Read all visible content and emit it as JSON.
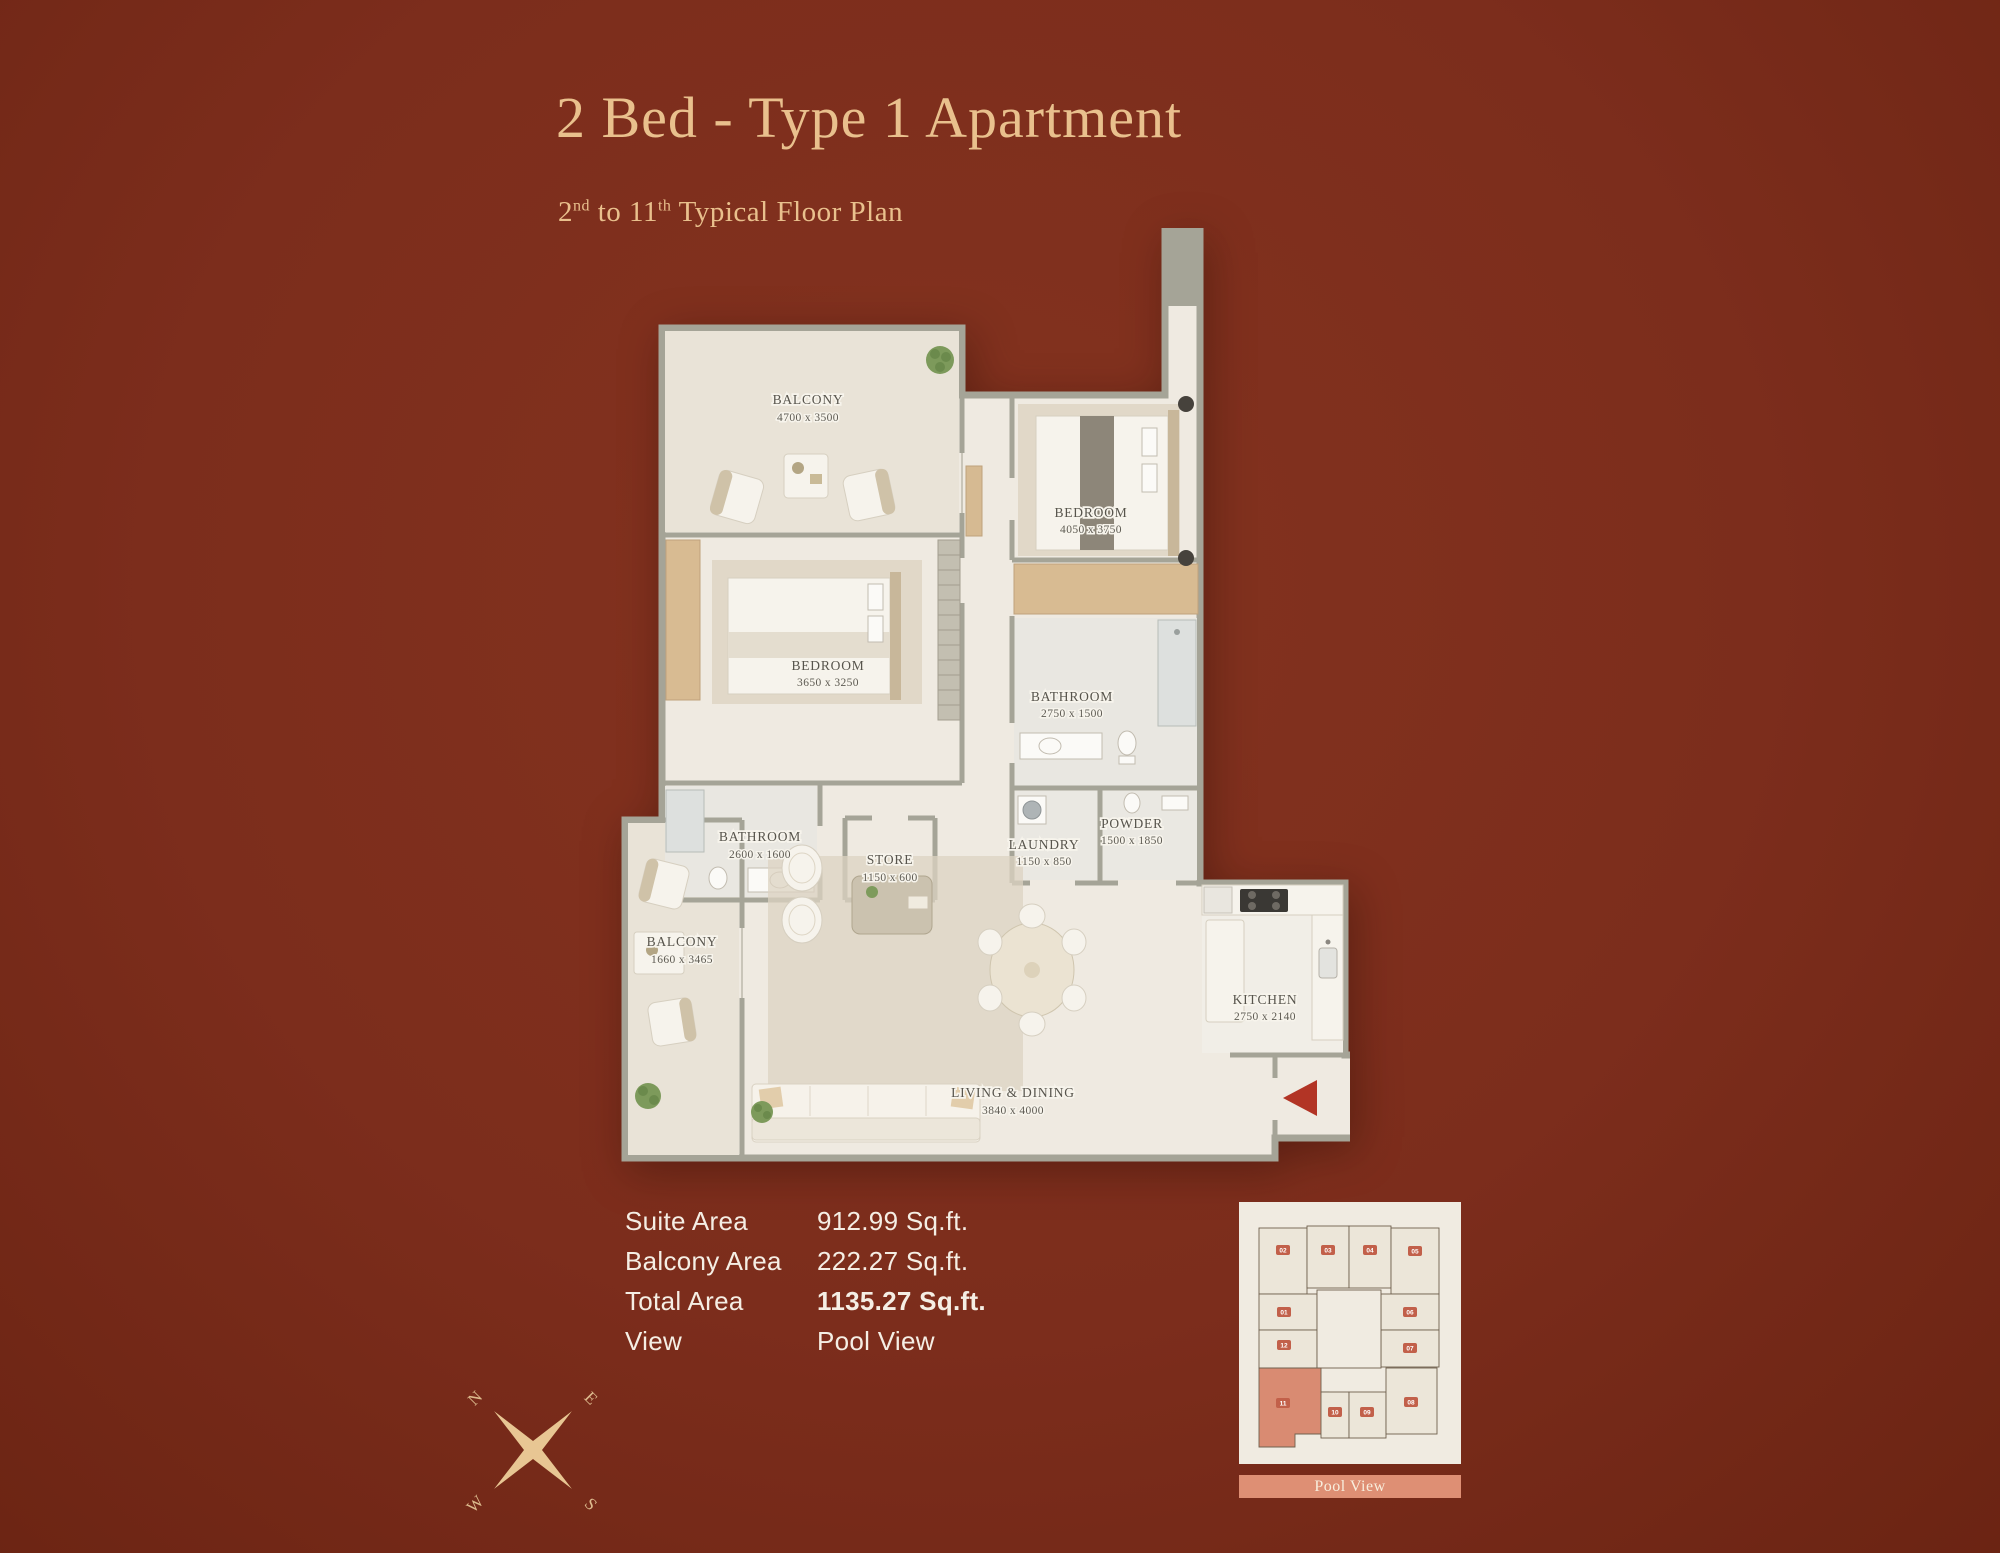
{
  "header": {
    "title": "2 Bed - Type 1 Apartment",
    "subtitle": {
      "base1": "2",
      "sup1": "nd",
      "base2": " to 11",
      "sup2": "th",
      "base3": " Typical Floor Plan"
    }
  },
  "floorplan": {
    "rooms": [
      {
        "name": "BALCONY",
        "dims": "4700 x 3500"
      },
      {
        "name": "BEDROOM",
        "dims": "4050 x 3750"
      },
      {
        "name": "BEDROOM",
        "dims": "3650 x 3250"
      },
      {
        "name": "BATHROOM",
        "dims": "2750 x 1500"
      },
      {
        "name": "POWDER",
        "dims": "1500 x 1850"
      },
      {
        "name": "LAUNDRY",
        "dims": "1150 x 850"
      },
      {
        "name": "BATHROOM",
        "dims": "2600 x 1600"
      },
      {
        "name": "STORE",
        "dims": "1150 x 600"
      },
      {
        "name": "BALCONY",
        "dims": "1660 x 3465"
      },
      {
        "name": "LIVING & DINING",
        "dims": "3840 x 4000"
      },
      {
        "name": "KITCHEN",
        "dims": "2750 x 2140"
      }
    ]
  },
  "areas": {
    "rows": [
      {
        "label": "Suite Area",
        "value": "912.99 Sq.ft."
      },
      {
        "label": "Balcony Area",
        "value": "222.27 Sq.ft."
      },
      {
        "label": "Total Area",
        "value": "1135.27 Sq.ft."
      },
      {
        "label": "View",
        "value": "Pool View"
      }
    ]
  },
  "compass": {
    "n": "N",
    "e": "E",
    "s": "S",
    "w": "W"
  },
  "keyplan": {
    "units": [
      {
        "number": "02"
      },
      {
        "number": "03"
      },
      {
        "number": "04"
      },
      {
        "number": "05"
      },
      {
        "number": "01"
      },
      {
        "number": "12"
      },
      {
        "number": "06"
      },
      {
        "number": "07"
      },
      {
        "number": "11"
      },
      {
        "number": "10"
      },
      {
        "number": "09"
      },
      {
        "number": "08"
      }
    ],
    "highlighted_unit": "11",
    "view_label": "Pool View"
  },
  "colors": {
    "background": "#7c2d1c",
    "accent_gold": "#e9c08d",
    "floor": "#efeae1",
    "wall": "#a5a497",
    "closet_tan": "#d8bb92",
    "entry_arrow": "#b23425",
    "keyplan_card": "#f0ebe1",
    "keyplan_badge": "#c2604a",
    "keyplan_highlight": "#d98b72",
    "pool_bar": "#de8f74"
  }
}
